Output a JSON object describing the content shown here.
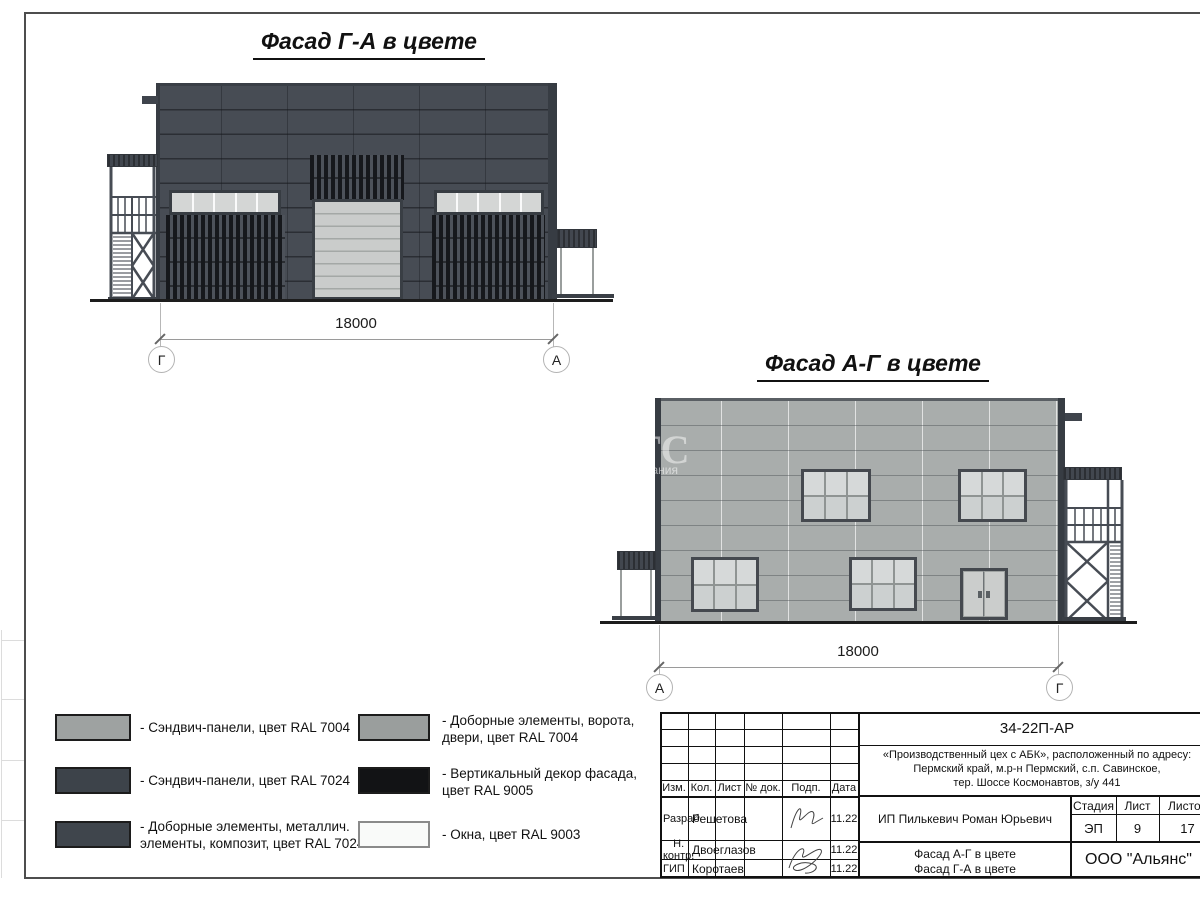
{
  "facade_ga": {
    "title": "Фасад Г-А в цвете",
    "dimension": "18000",
    "axis_left": "Г",
    "axis_right": "А"
  },
  "facade_ag": {
    "title": "Фасад А-Г в цвете",
    "dimension": "18000",
    "axis_left": "А",
    "axis_right": "Г"
  },
  "watermark": {
    "big": "ТС",
    "small": "пания"
  },
  "legend": {
    "items": [
      {
        "color": "#9ea2a1",
        "lines": [
          "- Сэндвич-панели, цвет RAL 7004"
        ]
      },
      {
        "color": "#3d434a",
        "lines": [
          "- Сэндвич-панели, цвет RAL 7024"
        ]
      },
      {
        "color": "#3f454c",
        "lines": [
          "- Доборные элементы, металлич.",
          "элементы, композит, цвет RAL 7024"
        ]
      },
      {
        "color": "#9a9e9d",
        "lines": [
          "- Доборные элементы, ворота,",
          "двери, цвет RAL 7004"
        ]
      },
      {
        "color": "#121315",
        "lines": [
          "- Вертикальный декор фасада,",
          "цвет RAL 9005"
        ]
      },
      {
        "color": "#f9faf9",
        "lines": [
          "- Окна, цвет RAL 9003"
        ]
      }
    ]
  },
  "title_block": {
    "doc_number": "34-22П-АР",
    "project_line1": "«Производственный цех с АБК», расположенный по адресу:",
    "project_line2": "Пермский край, м.р-н Пермский, с.п. Савинское,",
    "project_line3": "тер. Шоссе Космонавтов, з/у 441",
    "header_cols": {
      "izm": "Изм.",
      "kol": "Кол.",
      "list": "Лист",
      "doc": "№ док.",
      "podp": "Подп.",
      "data": "Дата"
    },
    "rows": [
      {
        "role": "Разраб.",
        "name": "Решетова",
        "date": "11.22"
      },
      {
        "role": "Н. контр.",
        "name": "Двоеглазов",
        "date": "11.22"
      },
      {
        "role": "ГИП",
        "name": "Коротаев",
        "date": "11.22"
      }
    ],
    "client": "ИП Пилькевич Роман Юрьевич",
    "stage_label": "Стадия",
    "sheet_label": "Лист",
    "sheets_label": "Листов",
    "stage": "ЭП",
    "sheet": "9",
    "sheets": "17",
    "sheet_title_line1": "Фасад А-Г в цвете",
    "sheet_title_line2": "Фасад Г-А в цвете",
    "company": "ООО \"Альянс\""
  },
  "colors": {
    "ral7004": "#9ea2a1",
    "ral7024": "#3d434a",
    "ral9005": "#121315",
    "ral9003": "#f9faf9",
    "facade_dark": "#474c54",
    "facade_light": "#a9adac",
    "ground": "#1d1d1d"
  }
}
